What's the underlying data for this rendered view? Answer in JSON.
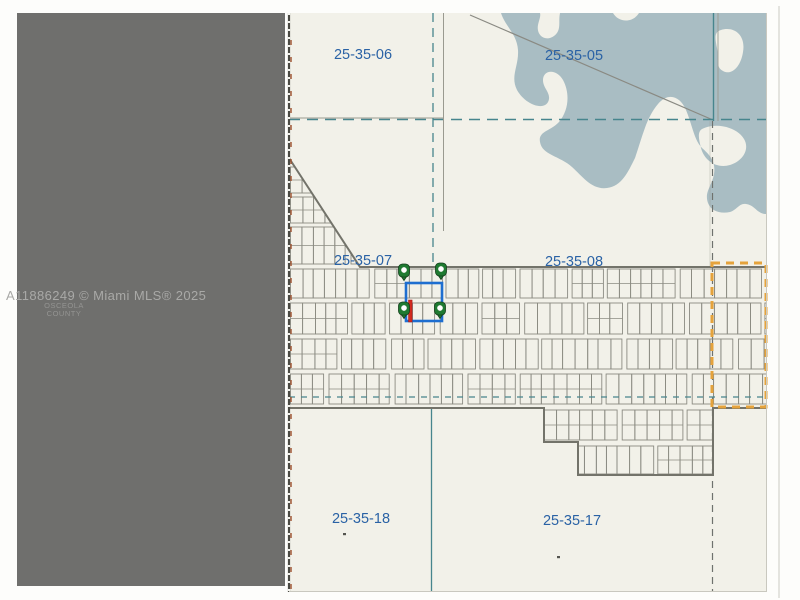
{
  "watermark": {
    "mls_line": "A11886249 © Miami MLS® 2025",
    "county_line1": "OSCEOLA",
    "county_line2": "COUNTY"
  },
  "map": {
    "section_labels": [
      {
        "id": "25-35-06",
        "x": 363,
        "y": 59
      },
      {
        "id": "25-35-05",
        "x": 574,
        "y": 60
      },
      {
        "id": "25-35-07",
        "x": 363,
        "y": 265
      },
      {
        "id": "25-35-08",
        "x": 574,
        "y": 266
      },
      {
        "id": "25-35-18",
        "x": 361,
        "y": 523
      },
      {
        "id": "25-35-17",
        "x": 572,
        "y": 525
      }
    ],
    "subject": {
      "highlight_rect": {
        "x": 406,
        "y": 283,
        "w": 36,
        "h": 38
      },
      "markers": [
        {
          "x": 404,
          "y": 272
        },
        {
          "x": 441,
          "y": 271
        },
        {
          "x": 404,
          "y": 310
        },
        {
          "x": 440,
          "y": 310
        }
      ],
      "flag": {
        "x": 408.5,
        "y": 300,
        "w": 3.6,
        "h": 22
      }
    },
    "search_outline": {
      "x": 712,
      "y": 263,
      "w": 54,
      "h": 144
    },
    "dots": [
      {
        "x": 343,
        "y": 533
      },
      {
        "x": 557,
        "y": 556
      }
    ],
    "colors": {
      "teal": "#47858d",
      "label_blue": "#2a62a5",
      "water": "#a9bdc3",
      "highlight_blue": "#1e6ed0",
      "marker_green": "#1f7a31",
      "flag_red": "#d22a1f",
      "outline_orange": "#e5a33c",
      "panel_gray": "#6f6f6d",
      "map_bg": "#f2f1e9"
    }
  }
}
